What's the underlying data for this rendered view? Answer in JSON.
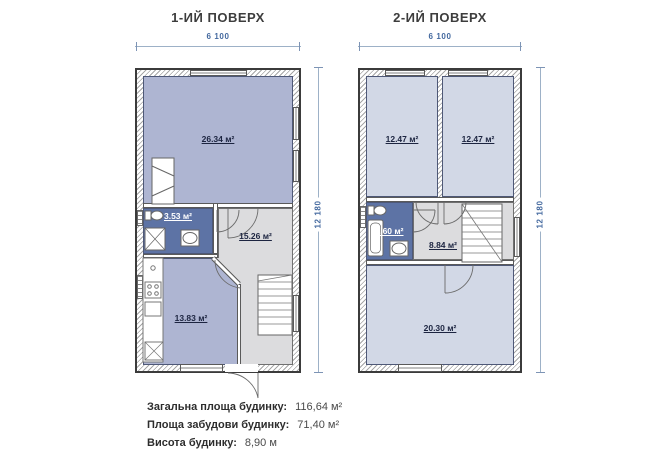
{
  "floor1": {
    "title": "1-ИЙ ПОВЕРХ",
    "dims": {
      "width": "6 100",
      "height": "12 180"
    },
    "rooms": {
      "living": "26.34 м²",
      "bathroom": "3.53 м²",
      "hall": "15.26 м²",
      "kitchen": "13.83 м²"
    }
  },
  "floor2": {
    "title": "2-ИЙ ПОВЕРХ",
    "dims": {
      "width": "6 100",
      "height": "12 180"
    },
    "rooms": {
      "bedroom_left": "12.47 м²",
      "bedroom_right": "12.47 м²",
      "bathroom": "3.60 м²",
      "hall": "8.84 м²",
      "living": "20.30 м²"
    }
  },
  "summary": {
    "rows": [
      {
        "label": "Загальна площа будинку:",
        "value": "116,64 м²"
      },
      {
        "label": "Площа забудови будинку:",
        "value": "71,40 м²"
      },
      {
        "label": "Висота будинку:",
        "value": "8,90 м"
      }
    ]
  },
  "colors": {
    "room_floor1": "#aeb5d2",
    "room_floor2": "#d2d8e6",
    "bathroom": "#5d73a5",
    "hall": "#dcdcde",
    "dim_text": "#44699f",
    "title_text": "#3d3d3d"
  }
}
